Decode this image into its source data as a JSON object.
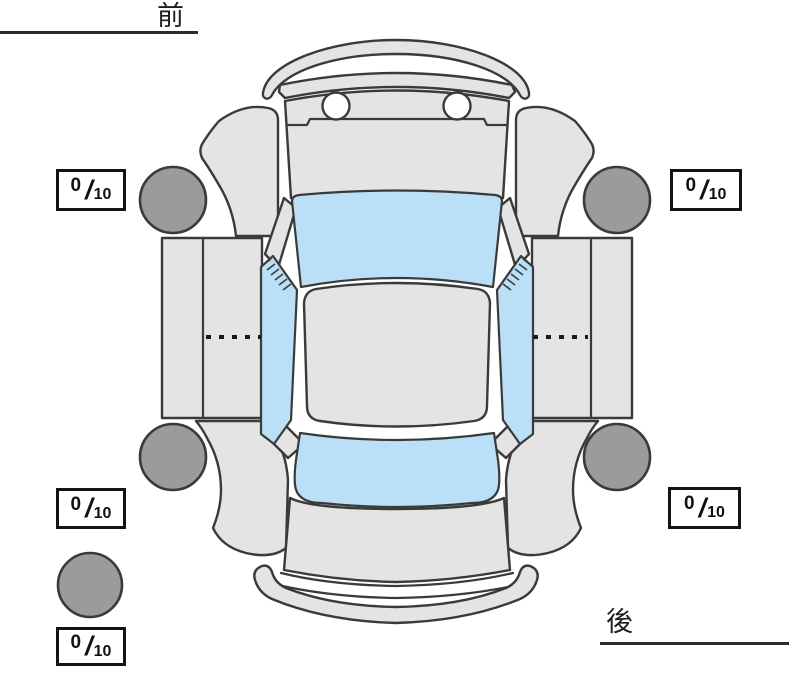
{
  "orientation": {
    "front_label": "前",
    "rear_label": "後"
  },
  "tread": {
    "slash": "/",
    "front_left": {
      "value": "0",
      "out_of": "10"
    },
    "front_right": {
      "value": "0",
      "out_of": "10"
    },
    "rear_left": {
      "value": "0",
      "out_of": "10"
    },
    "rear_right": {
      "value": "0",
      "out_of": "10"
    },
    "spare": {
      "value": "0",
      "out_of": "10"
    }
  },
  "colors": {
    "page_bg": "#ffffff",
    "body_fill": "#e4e4e4",
    "glass_fill": "#b9e0f6",
    "tire_fill": "#9b9b9b",
    "outline": "#3a3a3a",
    "box_border": "#141414",
    "text_color": "#111111"
  }
}
